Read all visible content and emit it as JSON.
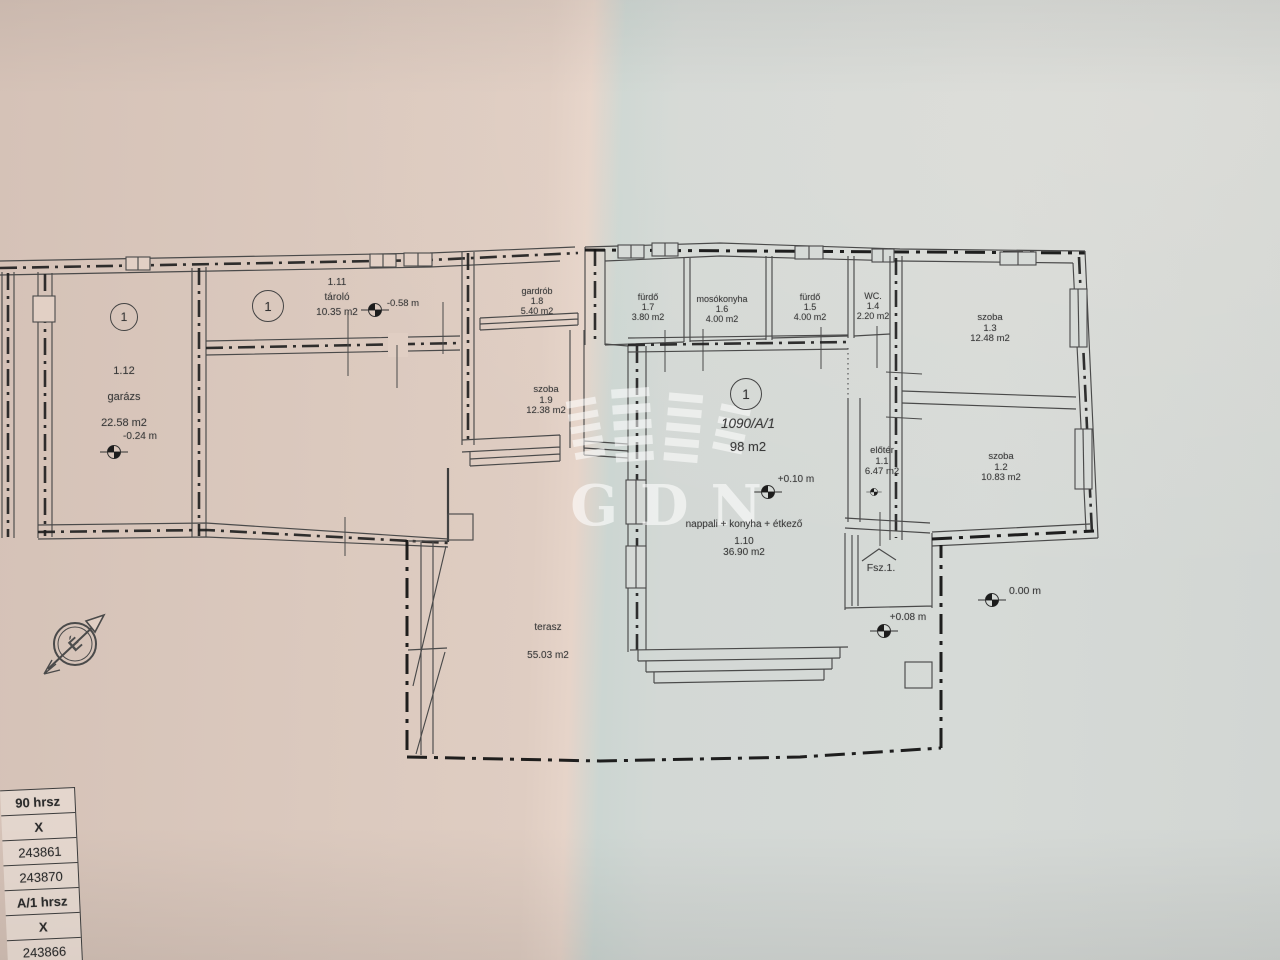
{
  "photo": {
    "watermark_text": "GDN"
  },
  "plan": {
    "unit_circle_label": "1",
    "parcel": {
      "id": "1090/A/1",
      "area": "98 m2"
    },
    "rooms": [
      {
        "key": "garazs",
        "lines": [
          "1.12",
          "garázs",
          "22.58 m2"
        ]
      },
      {
        "key": "tarolo",
        "lines": [
          "1.11",
          "tároló",
          "10.35 m2"
        ]
      },
      {
        "key": "gardrob",
        "lines": [
          "gardrób",
          "1.8",
          "5.40 m2"
        ]
      },
      {
        "key": "szoba-1-9",
        "lines": [
          "szoba",
          "1.9",
          "12.38 m2"
        ]
      },
      {
        "key": "furdo-1-7",
        "lines": [
          "fürdő",
          "1.7",
          "3.80 m2"
        ]
      },
      {
        "key": "mosokonyha",
        "lines": [
          "mosókonyha",
          "1.6",
          "4.00 m2"
        ]
      },
      {
        "key": "furdo-1-5",
        "lines": [
          "fürdő",
          "1.5",
          "4.00 m2"
        ]
      },
      {
        "key": "wc",
        "lines": [
          "WC.",
          "1.4",
          "2.20 m2"
        ]
      },
      {
        "key": "szoba-1-3",
        "lines": [
          "szoba",
          "1.3",
          "12.48 m2"
        ]
      },
      {
        "key": "szoba-1-2",
        "lines": [
          "szoba",
          "1.2",
          "10.83 m2"
        ]
      },
      {
        "key": "eloter",
        "lines": [
          "előtér",
          "1.1",
          "6.47 m2"
        ]
      },
      {
        "key": "nappali",
        "lines": [
          "nappali + konyha + étkező",
          "1.10",
          "36.90 m2"
        ]
      },
      {
        "key": "terasz",
        "lines": [
          "terasz",
          "55.03 m2"
        ]
      }
    ],
    "elevations": [
      {
        "key": "garazs",
        "label": "-0.24 m"
      },
      {
        "key": "tarolo",
        "label": "-0.58 m"
      },
      {
        "key": "nappali",
        "label": "+0.10 m"
      },
      {
        "key": "udvar1",
        "label": "+0.08 m"
      },
      {
        "key": "udvar2",
        "label": "0.00 m"
      }
    ],
    "entrance_label": "Fsz.1.",
    "north_letter": "É"
  },
  "table": {
    "rows": [
      {
        "text": "90 hrsz",
        "bold": true
      },
      {
        "text": "X",
        "bold": true
      },
      {
        "text": "243861",
        "bold": false
      },
      {
        "text": "243870",
        "bold": false
      },
      {
        "text": "A/1 hrsz",
        "bold": true
      },
      {
        "text": "X",
        "bold": true
      },
      {
        "text": "243866",
        "bold": false
      },
      {
        "text": "/2 hrsz",
        "bold": true
      }
    ]
  }
}
